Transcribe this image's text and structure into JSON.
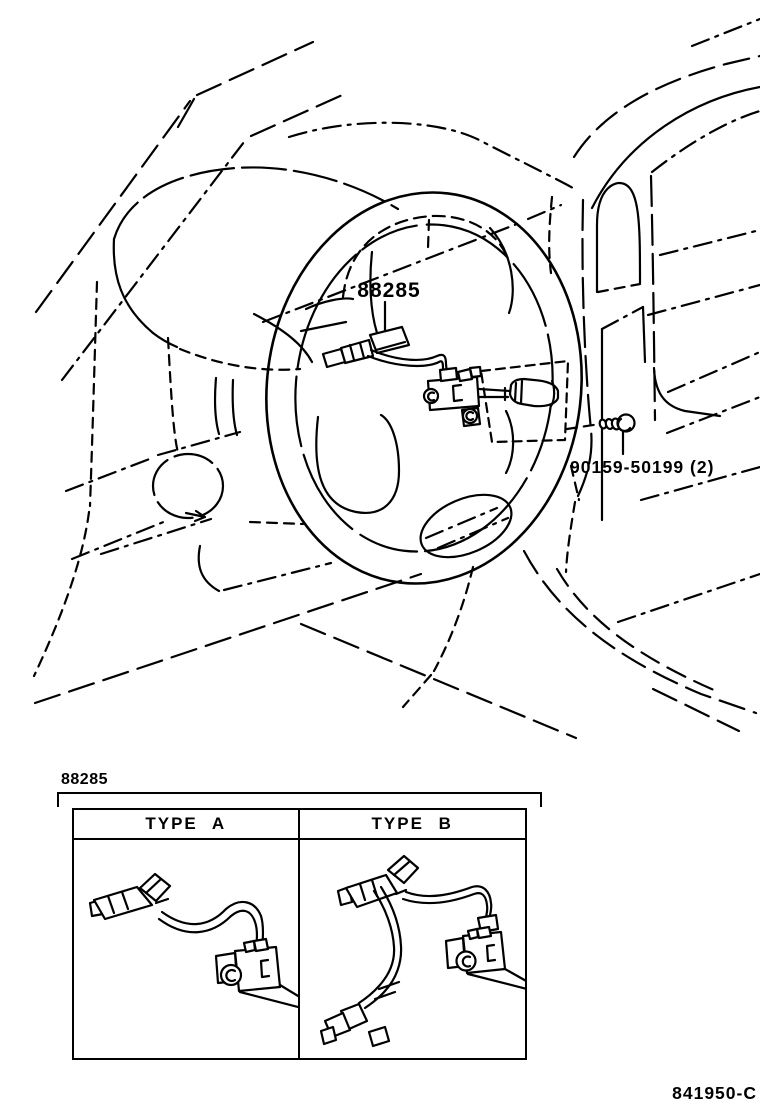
{
  "page": {
    "background_color": "#ffffff",
    "line_color": "#000000"
  },
  "main_diagram": {
    "description": "dashboard-and-steering-wheel-line-art",
    "callout_88285": "88285",
    "callout_screw": "90159-50199 (2)"
  },
  "variants": {
    "group_label": "88285",
    "columns": [
      {
        "label": "TYPE A"
      },
      {
        "label": "TYPE B"
      }
    ]
  },
  "footer": {
    "figure_code": "841950-C"
  }
}
